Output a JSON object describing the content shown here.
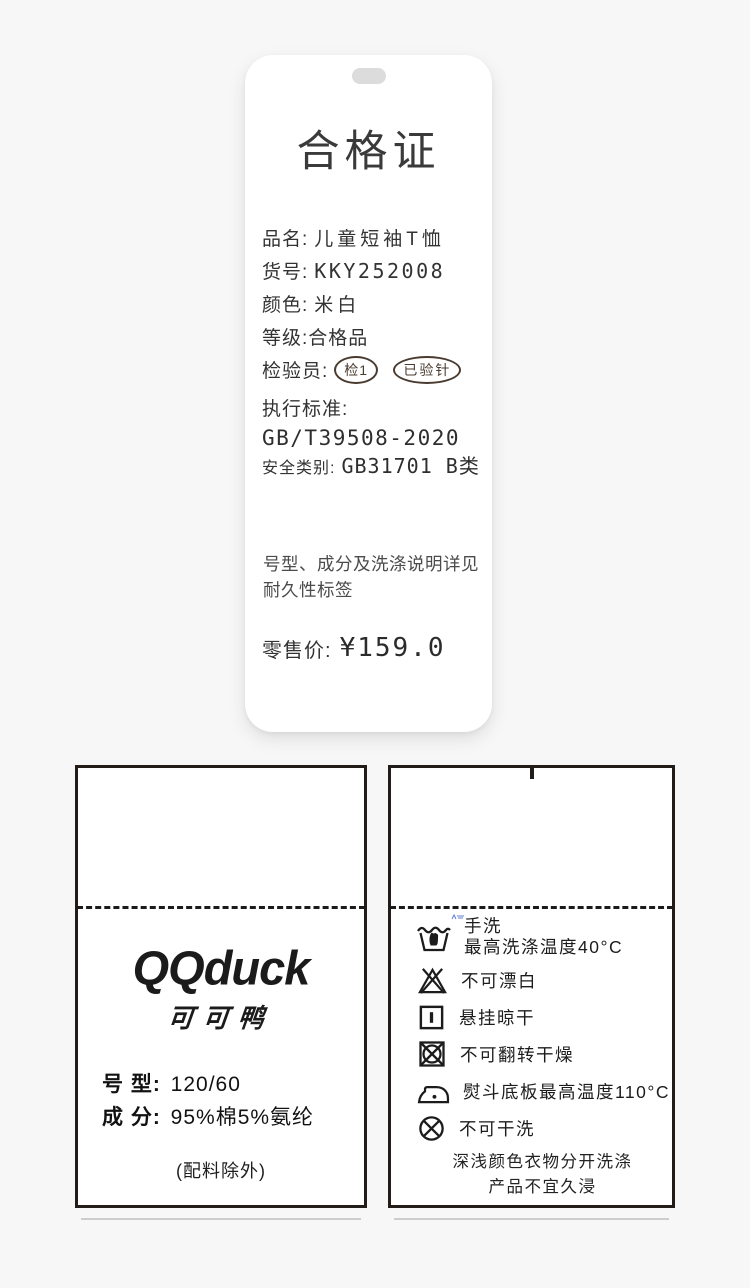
{
  "hang_tag": {
    "title": "合格证",
    "fields": [
      {
        "label": "品名:",
        "value": "儿童短袖T恤"
      },
      {
        "label": "货号:",
        "value": "KKY252008"
      },
      {
        "label": "颜色:",
        "value": "米白"
      },
      {
        "label": "等级:",
        "value": "合格品"
      },
      {
        "label": "检验员:",
        "value": ""
      }
    ],
    "stamps": [
      "检1",
      "已验针"
    ],
    "standard_label": "执行标准:",
    "standard_value": "GB/T39508-2020",
    "safety_label": "安全类别:",
    "safety_value": "GB31701 B类",
    "note_line1": "号型、成分及洗涤说明详见",
    "note_line2": "耐久性标签",
    "price_label": "零售价:",
    "price_value": "¥159.0"
  },
  "left_label": {
    "brand_en": "QQduck",
    "brand_cn": "可可鸭",
    "rows": [
      {
        "label": "号 型:",
        "value": "120/60"
      },
      {
        "label": "成 分:",
        "value": "95%棉5%氨纶"
      }
    ],
    "note": "(配料除外)"
  },
  "right_label": {
    "care_items": [
      {
        "icon": "handwash-icon",
        "lines": [
          "手洗",
          "最高洗涤温度40°C"
        ]
      },
      {
        "icon": "no-bleach-icon",
        "lines": [
          "不可漂白"
        ]
      },
      {
        "icon": "hang-dry-icon",
        "lines": [
          "悬挂晾干"
        ]
      },
      {
        "icon": "no-tumble-dry-icon",
        "lines": [
          "不可翻转干燥"
        ]
      },
      {
        "icon": "iron-max-110-icon",
        "lines": [
          "熨斗底板最高温度110°C"
        ]
      },
      {
        "icon": "no-dry-clean-icon",
        "lines": [
          "不可干洗"
        ]
      }
    ],
    "footnote_line1": "深浅颜色衣物分开洗涤",
    "footnote_line2": "产品不宜久浸"
  },
  "colors": {
    "background": "#f7f7f7",
    "card": "#ffffff",
    "ink": "#333333",
    "label_ink": "#1c1c1c",
    "stamp": "#4a3b30",
    "border": "#231d19",
    "artifact_blue": "#5b7fd6"
  }
}
